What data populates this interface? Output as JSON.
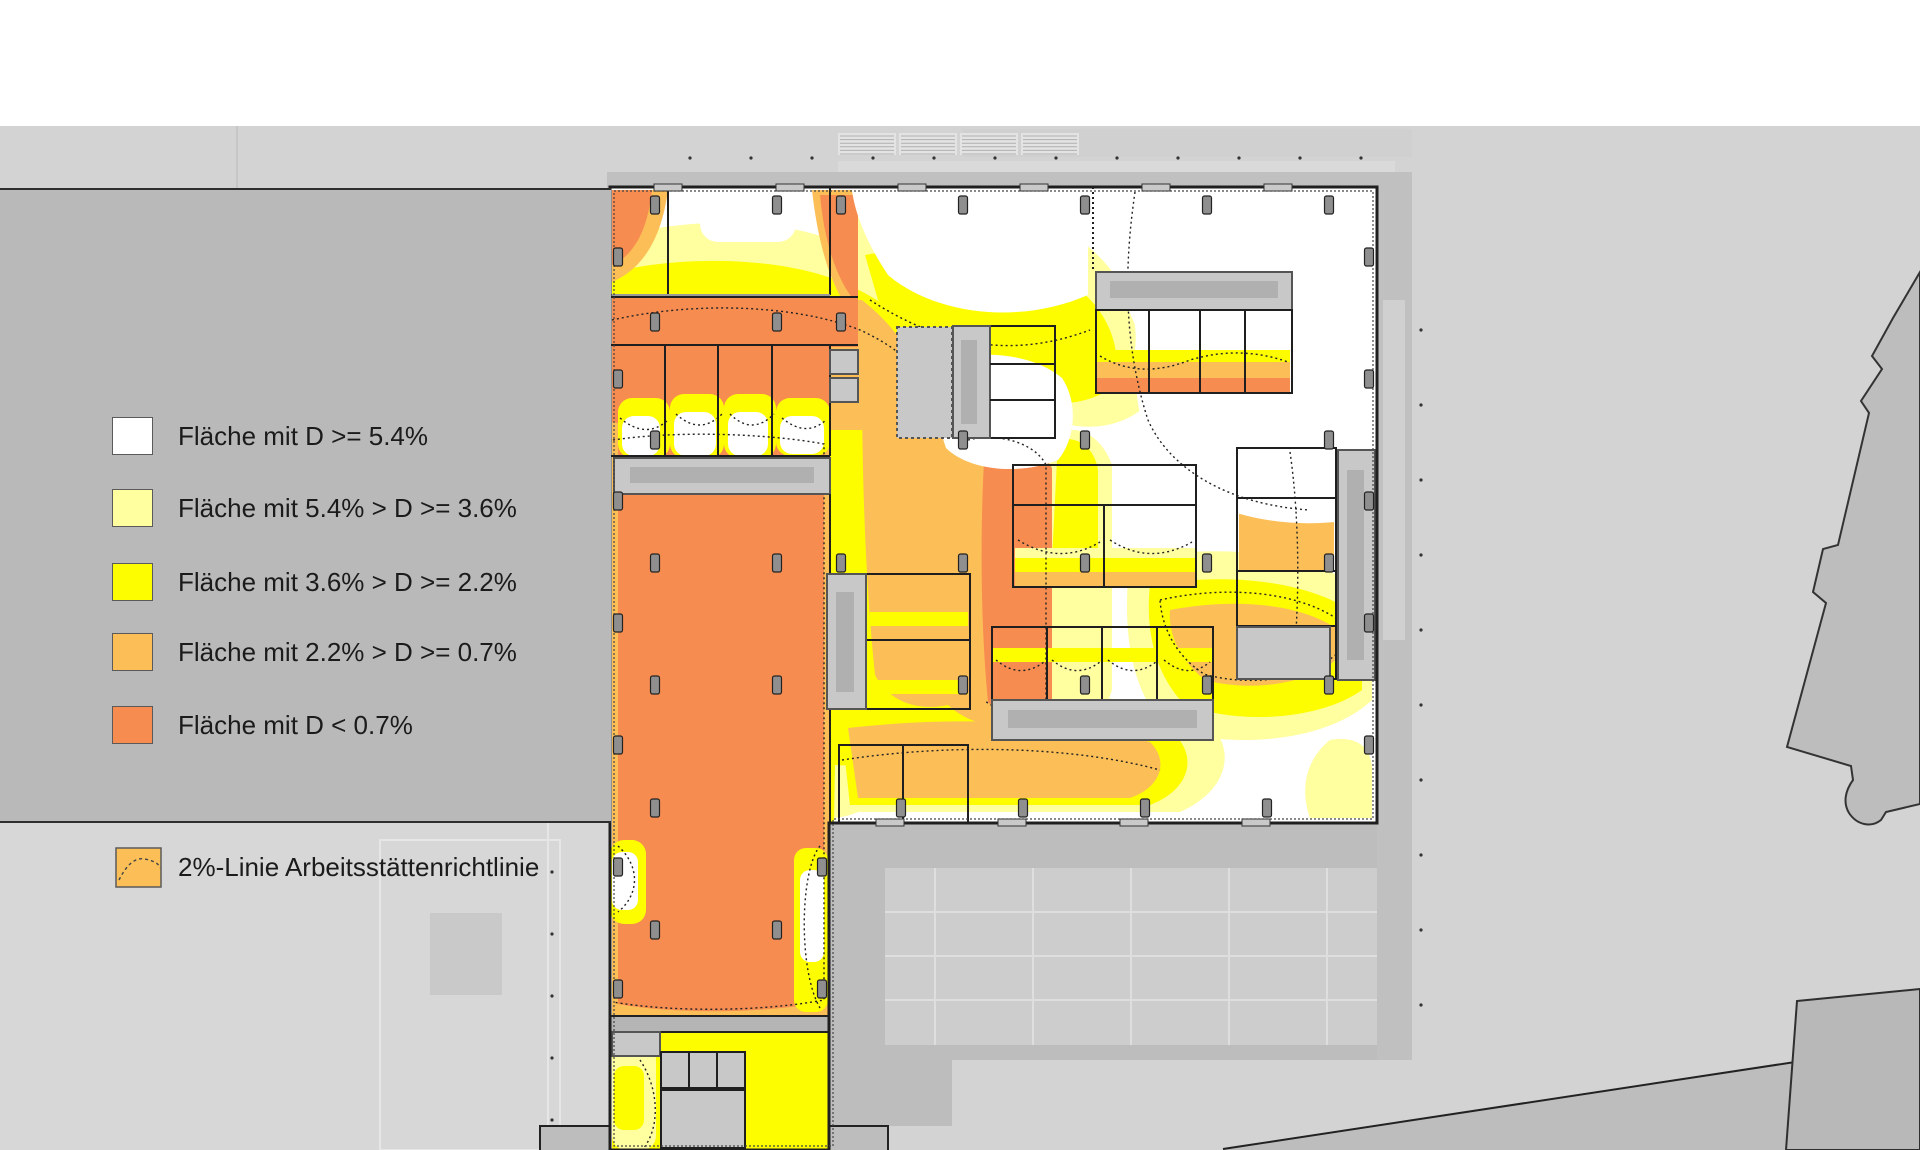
{
  "legend": {
    "items": [
      {
        "label": "Fläche mit D >= 5.4%",
        "color": "#ffffff"
      },
      {
        "label": "Fläche mit 5.4% > D >= 3.6%",
        "color": "#ffffa0"
      },
      {
        "label": "Fläche mit 3.6% > D >= 2.2%",
        "color": "#fdfd00"
      },
      {
        "label": "Fläche mit 2.2% > D >= 0.7%",
        "color": "#fcbf57"
      },
      {
        "label": "Fläche mit D < 0.7%",
        "color": "#f78c50"
      }
    ],
    "note": {
      "label": "2%-Linie Arbeitsstättenrichtlinie",
      "color": "#fcbf57"
    }
  },
  "palette": {
    "page_bg": "#d3d3d3",
    "top_band": "#ffffff",
    "legend_panel": "#b9b9b9",
    "text": "#1b1b1b",
    "d_white": "#ffffff",
    "d_pale_yellow": "#ffffa0",
    "d_yellow": "#fdfd00",
    "d_light_orange": "#fcbf57",
    "d_dark_orange": "#f78c50",
    "wall": "#1f1f1f",
    "core_gray": "#c8c8c8",
    "core_inner": "#b0b0b0",
    "walkway": "#c0c0c0",
    "terrace": "#bdbdbd",
    "paving": "#cdcdcd",
    "context_fill": "#bdbdbd",
    "context_line": "#333333",
    "column_fill": "#8f8f8f"
  }
}
